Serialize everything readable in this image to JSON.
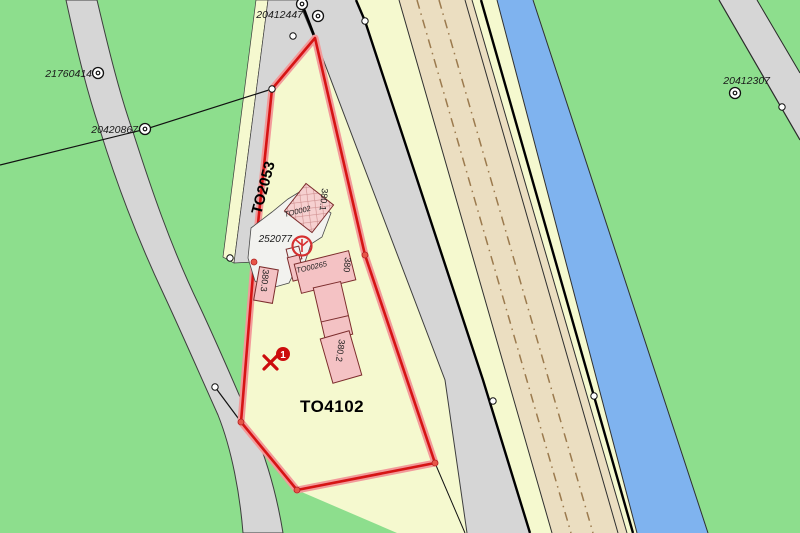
{
  "labels": {
    "survey_points": [
      {
        "id": "20412447"
      },
      {
        "id": "21760414"
      },
      {
        "id": "20420867"
      },
      {
        "id": "20412307"
      }
    ],
    "parcels": {
      "road_parcel": "TO2053",
      "main_parcel": "TO4102"
    },
    "buildings": {
      "b1": "380.1",
      "b2": "380.2",
      "b3": "380.3",
      "main": "380",
      "code_upper": "TO0002",
      "code_lower": "TO00265"
    },
    "survey_point_number": "252077",
    "annotation_badge": "1"
  },
  "colors": {
    "background_green": "#8dde8d",
    "parcel_fill_yellow": "#f5f9cf",
    "road_gray": "#d6d6d6",
    "highway_beige": "#ebdec1",
    "water_blue": "#7fb3ef",
    "parcel_outline_red": "#d61414",
    "parcel_outline_halo": "#f29a9a",
    "building_pink": "#f4c2c4",
    "annotation_red": "#cc0d0d",
    "dashline_brown": "#9b7a4e"
  }
}
